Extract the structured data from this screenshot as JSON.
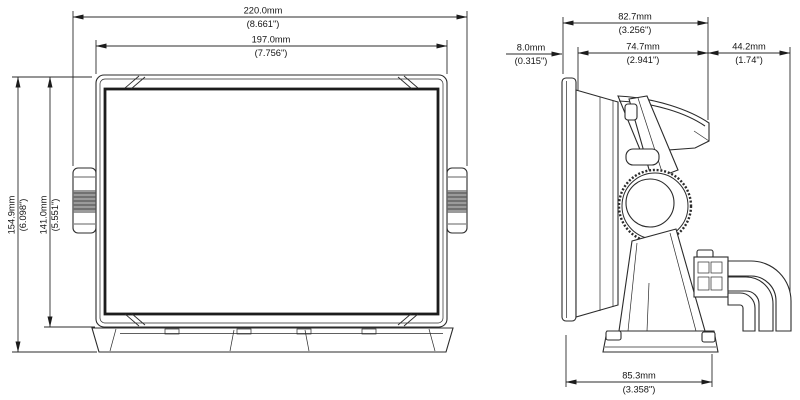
{
  "drawing": {
    "type": "technical-dimension-drawing",
    "views": {
      "front": "front-view",
      "side": "side-view"
    },
    "line_color": "#2b2b2b",
    "dims": {
      "front": [
        {
          "id": "width-overall",
          "mm": "220.0mm",
          "inch": "(8.661\")"
        },
        {
          "id": "width-housing",
          "mm": "197.0mm",
          "inch": "(7.756\")"
        },
        {
          "id": "height-overall",
          "mm": "154.9mm",
          "inch": "(6.098\")"
        },
        {
          "id": "height-housing",
          "mm": "141.0mm",
          "inch": "(5.551\")"
        }
      ],
      "side": [
        {
          "id": "depth-overall",
          "mm": "82.7mm",
          "inch": "(3.256\")"
        },
        {
          "id": "front-protrusion",
          "mm": "8.0mm",
          "inch": "(0.315\")"
        },
        {
          "id": "depth-body",
          "mm": "74.7mm",
          "inch": "(2.941\")"
        },
        {
          "id": "cable-clearance",
          "mm": "44.2mm",
          "inch": "(1.74\")"
        },
        {
          "id": "base-depth",
          "mm": "85.3mm",
          "inch": "(3.358\")"
        }
      ]
    }
  }
}
